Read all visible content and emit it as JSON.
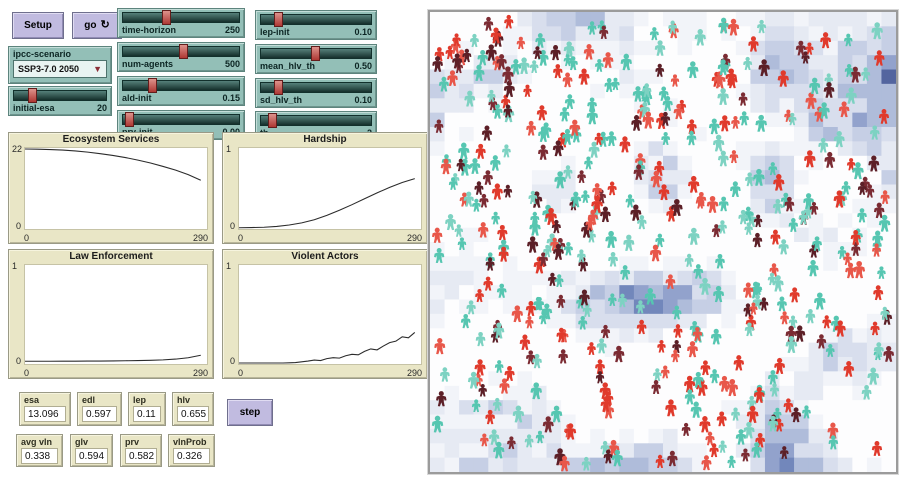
{
  "buttons": {
    "setup": "Setup",
    "go": "go",
    "step": "step"
  },
  "chooser": {
    "label": "ipcc-scenario",
    "value": "SSP3-7.0 2050"
  },
  "sliders": [
    {
      "id": "time-horizon",
      "label": "time-horizon",
      "value": "250",
      "frac": 0.36
    },
    {
      "id": "num-agents",
      "label": "num-agents",
      "value": "500",
      "frac": 0.52
    },
    {
      "id": "ald-init",
      "label": "ald-init",
      "value": "0.15",
      "frac": 0.24
    },
    {
      "id": "prv-init",
      "label": "prv-init",
      "value": "0.00",
      "frac": 0.03
    },
    {
      "id": "lep-init",
      "label": "lep-init",
      "value": "0.10",
      "frac": 0.13
    },
    {
      "id": "mean_hlv_th",
      "label": "mean_hlv_th",
      "value": "0.50",
      "frac": 0.49
    },
    {
      "id": "sd_hlv_th",
      "label": "sd_hlv_th",
      "value": "0.10",
      "frac": 0.13
    },
    {
      "id": "th",
      "label": "th",
      "value": "2",
      "frac": 0.08
    },
    {
      "id": "initial-esa",
      "label": "initial-esa",
      "value": "20",
      "frac": 0.18
    }
  ],
  "monitors": [
    {
      "label": "esa",
      "value": "13.096"
    },
    {
      "label": "edl",
      "value": "0.597"
    },
    {
      "label": "lep",
      "value": "0.11"
    },
    {
      "label": "hlv",
      "value": "0.655"
    },
    {
      "label": "avg vln",
      "value": "0.338"
    },
    {
      "label": "glv",
      "value": "0.594"
    },
    {
      "label": "prv",
      "value": "0.582"
    },
    {
      "label": "vlnProb",
      "value": "0.326"
    }
  ],
  "chart_data": [
    {
      "id": "ecosystem-services",
      "type": "line",
      "title": "Ecosystem Services",
      "xlabel": "",
      "ylabel": "",
      "xlim": [
        0,
        290
      ],
      "ylim": [
        0,
        22
      ],
      "x_tick_labels": [
        "0",
        "290"
      ],
      "y_tick_labels": [
        "0",
        "22"
      ],
      "x": [
        0,
        20,
        40,
        60,
        80,
        100,
        120,
        140,
        160,
        180,
        200,
        220,
        240,
        260,
        280
      ],
      "y": [
        22,
        21.95,
        21.85,
        21.7,
        21.45,
        21.12,
        20.7,
        20.2,
        19.6,
        18.9,
        18.1,
        17.15,
        16.1,
        14.85,
        13.3
      ]
    },
    {
      "id": "hardship",
      "type": "line",
      "title": "Hardship",
      "xlabel": "",
      "ylabel": "",
      "xlim": [
        0,
        290
      ],
      "ylim": [
        0,
        1
      ],
      "x_tick_labels": [
        "0",
        "290"
      ],
      "y_tick_labels": [
        "0",
        "1"
      ],
      "x": [
        0,
        20,
        40,
        60,
        80,
        100,
        120,
        140,
        160,
        180,
        200,
        220,
        240,
        260,
        280
      ],
      "y": [
        0.004,
        0.006,
        0.01,
        0.02,
        0.038,
        0.065,
        0.105,
        0.16,
        0.225,
        0.295,
        0.37,
        0.445,
        0.515,
        0.575,
        0.625
      ]
    },
    {
      "id": "law-enforcement",
      "type": "line",
      "title": "Law Enforcement",
      "xlabel": "",
      "ylabel": "",
      "xlim": [
        0,
        290
      ],
      "ylim": [
        0,
        1
      ],
      "x_tick_labels": [
        "0",
        "290"
      ],
      "y_tick_labels": [
        "0",
        "1"
      ],
      "x": [
        0,
        20,
        40,
        60,
        80,
        100,
        120,
        140,
        160,
        180,
        200,
        220,
        240,
        260,
        280
      ],
      "y": [
        0.018,
        0.018,
        0.018,
        0.019,
        0.019,
        0.02,
        0.02,
        0.021,
        0.023,
        0.025,
        0.028,
        0.032,
        0.04,
        0.055,
        0.08
      ]
    },
    {
      "id": "violent-actors",
      "type": "line",
      "title": "Violent Actors",
      "xlabel": "",
      "ylabel": "",
      "xlim": [
        0,
        290
      ],
      "ylim": [
        0,
        1
      ],
      "x_tick_labels": [
        "0",
        "290"
      ],
      "y_tick_labels": [
        "0",
        "1"
      ],
      "x": [
        0,
        10,
        20,
        30,
        40,
        50,
        60,
        70,
        80,
        90,
        100,
        110,
        120,
        130,
        140,
        150,
        160,
        170,
        180,
        190,
        200,
        210,
        220,
        230,
        240,
        250,
        260,
        270,
        280
      ],
      "y": [
        0,
        0,
        0,
        0,
        0,
        0,
        0,
        0,
        0.002,
        0.005,
        0.012,
        0.02,
        0.03,
        0.025,
        0.045,
        0.055,
        0.05,
        0.075,
        0.09,
        0.085,
        0.12,
        0.145,
        0.135,
        0.175,
        0.21,
        0.225,
        0.27,
        0.26,
        0.315
      ]
    }
  ],
  "world": {
    "agent_count": 470,
    "agent_colors": {
      "teal": [
        "#56c6b1",
        "#7dd2c2"
      ],
      "red": [
        "#e03a2c",
        "#e8574a"
      ],
      "maroon": [
        "#5c1f27",
        "#7b2b33"
      ]
    },
    "agent_color_weights": {
      "teal": 0.43,
      "red": 0.33,
      "maroon": 0.24
    },
    "patch_palette": [
      "#fdfdfe",
      "#f2f4f9",
      "#e6eaf3",
      "#d8deed",
      "#c6cfe5",
      "#afbcda",
      "#92a2cc",
      "#7287bb",
      "#53659f"
    ],
    "patch_thresholds": [
      0.42,
      0.52,
      0.6,
      0.67,
      0.74,
      0.81,
      0.88,
      0.94
    ],
    "curve_color": "#2b2b2b",
    "plot_bg": "#ffffff"
  }
}
